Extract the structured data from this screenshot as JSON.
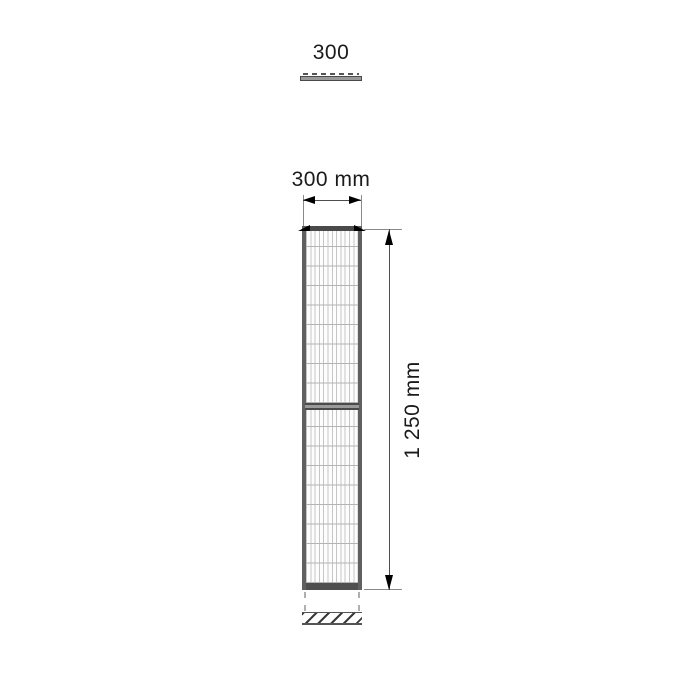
{
  "drawing": {
    "top_view": {
      "width_label": "300"
    },
    "front_view": {
      "width_label": "300 mm",
      "height_label": "1 250 mm"
    },
    "colors": {
      "background": "#ffffff",
      "text": "#1a1a1a",
      "dimension_line": "#4d4d4d",
      "extension_line": "#8a8a8a",
      "arrow": "#000000",
      "frame": "#606060",
      "rail_dark": "#4a4a4a",
      "rail_fill": "#9a9a9a",
      "mesh_vertical_line": "#c6c6c6",
      "mesh_horizontal_line": "#b4b4b4",
      "dashed_line": "#b0b0b0",
      "hatch": "#3a3a3a"
    }
  }
}
